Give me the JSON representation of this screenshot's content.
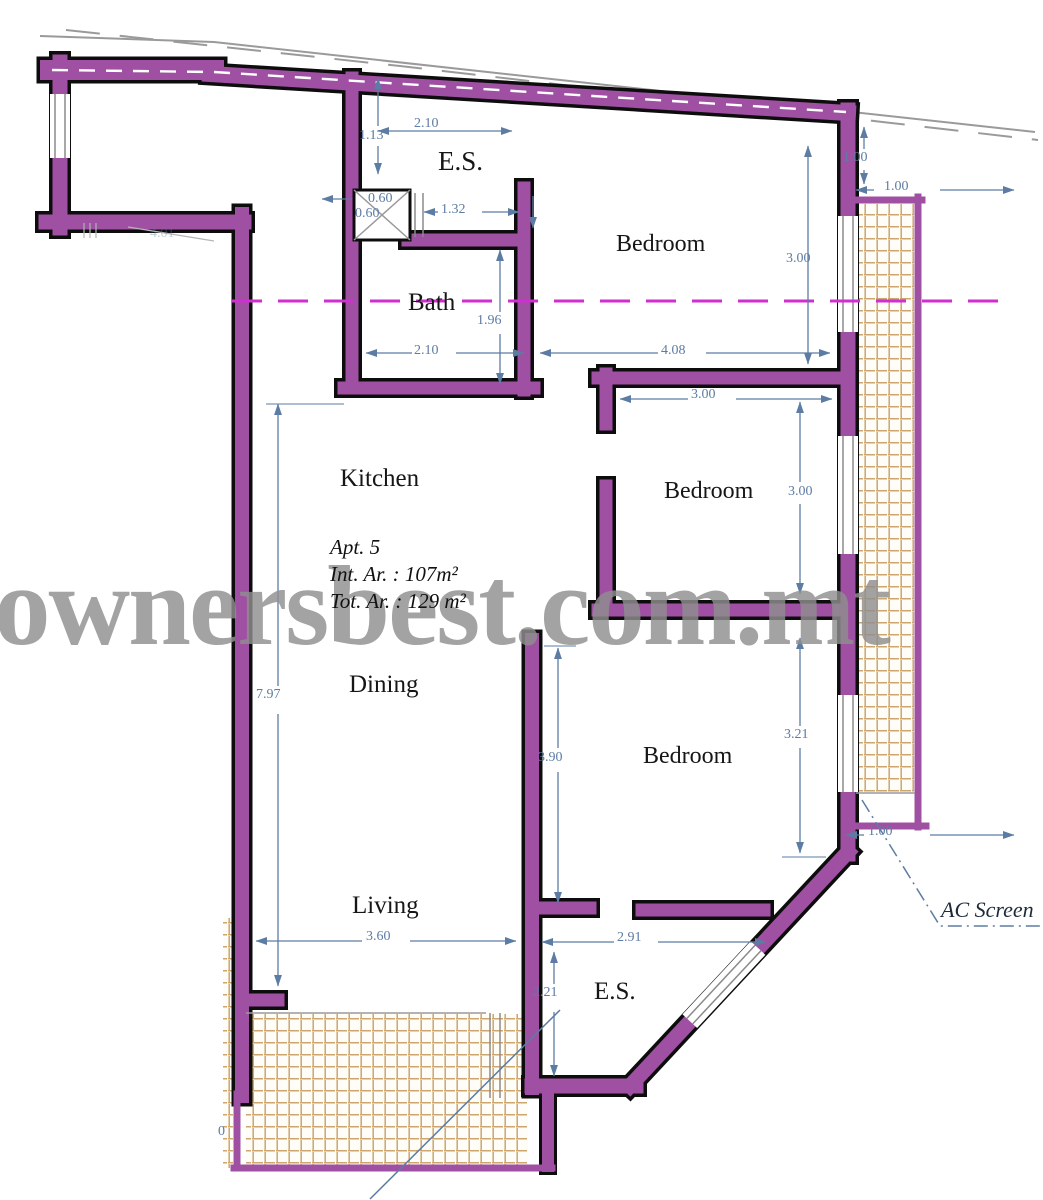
{
  "watermark": {
    "text": "ownersbest.com.mt"
  },
  "apartment": {
    "label": "Apt. 5",
    "internal_area": "Int. Ar. : 107m²",
    "total_area": "Tot. Ar. : 129 m²"
  },
  "rooms": {
    "es_top": "E.S.",
    "bedroom_top": "Bedroom",
    "bath": "Bath",
    "kitchen": "Kitchen",
    "dining": "Dining",
    "bedroom_middle": "Bedroom",
    "bedroom_bottom": "Bedroom",
    "living": "Living",
    "es_bottom": "E.S."
  },
  "annotations": {
    "ac_screen": "AC Screen"
  },
  "dimensions": {
    "entry_top_width": "2.10",
    "entry_top_depth": "1.13",
    "shaft_width": "0.60",
    "shaft_depth": "0.60",
    "hall_opening": "1.32",
    "bath_depth": "1.96",
    "bath_width": "2.10",
    "bedroom_top_width": "4.08",
    "bedroom_top_depth": "3.00",
    "ac_right_setback_v": "1.00",
    "ac_right_setback_h": "1.00",
    "bedroom_middle_width": "3.00",
    "bedroom_middle_depth": "3.00",
    "kitchen_dining_depth": "7.97",
    "hall_depth": "3.90",
    "bedroom_bottom_depth": "3.21",
    "ac_right_width": "1.00",
    "living_width": "3.60",
    "es_bottom_width": "2.91",
    "es_bottom_depth": "2.21",
    "left_partial": "0",
    "entry_width": "4.01"
  },
  "colors": {
    "wall": "#a050a2",
    "dimension": "#5d7ca3",
    "centerline": "#d02ed0",
    "tile_line": "#cda56f",
    "watermark": "#8f8f8f"
  }
}
